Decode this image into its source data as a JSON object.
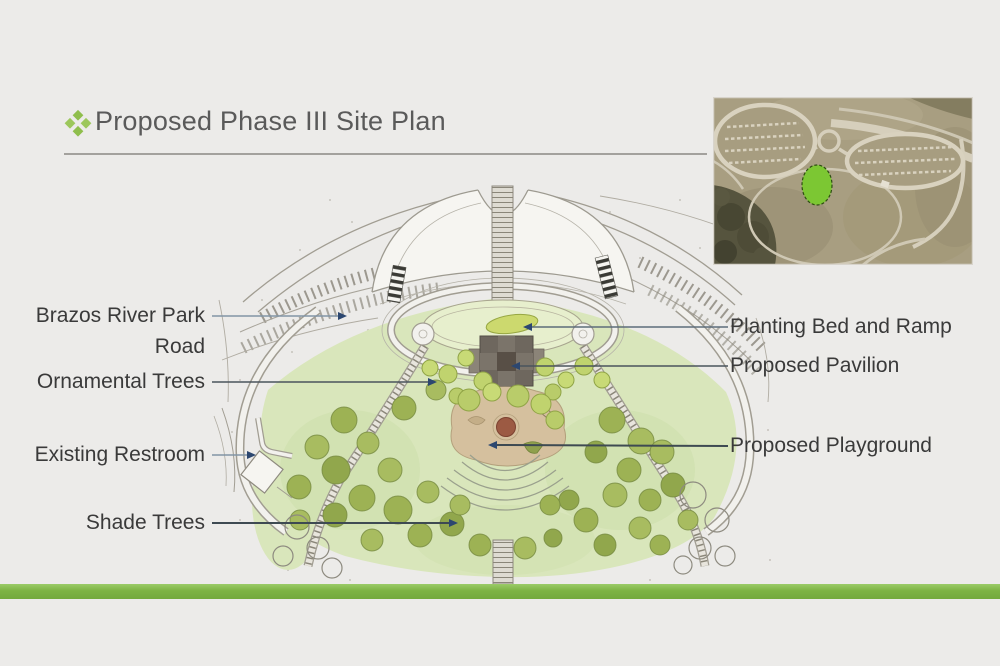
{
  "slide": {
    "title": "Proposed Phase III Site Plan",
    "colors": {
      "background": "#ECEBE9",
      "title_text": "#5A5A5A",
      "label_text": "#3A3A3A",
      "accent_green": "#8CBF4A",
      "footer_bar": "#7DB344",
      "title_underline": "#A3A19D"
    }
  },
  "callouts": {
    "left": [
      {
        "text": "Brazos River Park Road"
      },
      {
        "text": "Ornamental Trees"
      },
      {
        "text": "Existing Restroom"
      },
      {
        "text": "Shade Trees"
      }
    ],
    "right": [
      {
        "text": "Planting Bed and Ramp"
      },
      {
        "text": "Proposed Pavilion"
      },
      {
        "text": "Proposed Playground"
      }
    ]
  },
  "site_plan": {
    "colors": {
      "canopy_wash": "#D9E6BB",
      "shade_tree": "#9DB254",
      "ornamental_tree": "#C0D36E",
      "playground_surface": "#D5C09E",
      "playground_feature": "#9C5A43",
      "pavilion": "#6E675E",
      "path_edge": "#A19D92",
      "leader_line": "#46545E",
      "leader_arrow": "#2C4770"
    }
  },
  "inset": {
    "kind": "aerial-photo",
    "colors": {
      "ground": "#A89E81",
      "roads": "#D9D2BF",
      "tree_mass": "#56543E",
      "site_highlight": "#7CC733"
    }
  }
}
